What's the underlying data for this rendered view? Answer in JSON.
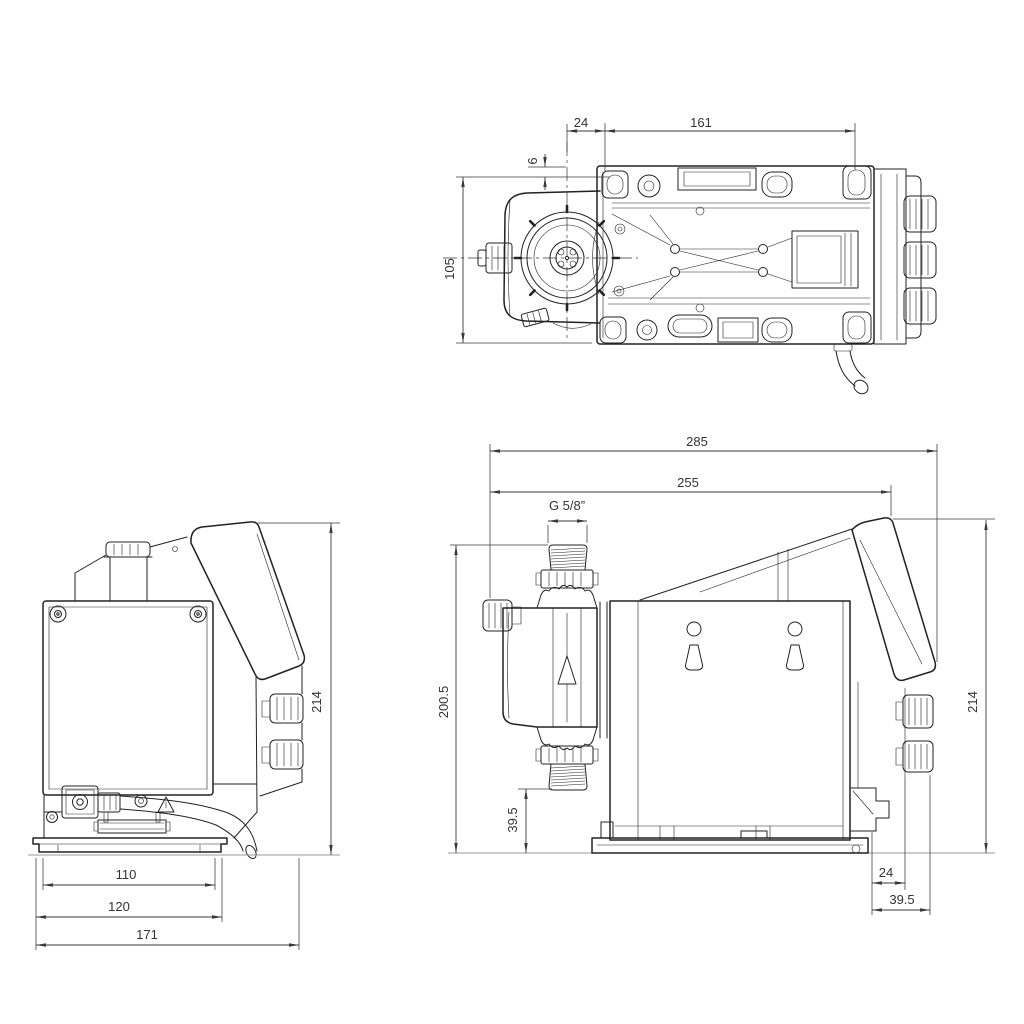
{
  "meta": {
    "background_color": "#ffffff",
    "line_color": "#222222",
    "dimension_color": "#3a3a3a",
    "units": "mm"
  },
  "views": {
    "top": {
      "name": "top-view",
      "dims": {
        "center_to_hole": "24",
        "hole_span": "161",
        "edge_offset": "6",
        "plate_depth": "105"
      }
    },
    "front": {
      "name": "front-view",
      "dims": {
        "head_width": "110",
        "base_width": "120",
        "overall_width": "171",
        "overall_height": "214"
      }
    },
    "side": {
      "name": "side-view",
      "thread_label": "G 5/8”",
      "dims": {
        "overall_length": "285",
        "length_to_panel": "255",
        "height_to_connection": "200.5",
        "suction_height": "39.5",
        "overall_height": "214",
        "rear_offset": "24",
        "rear_overhang": "39.5"
      }
    }
  }
}
